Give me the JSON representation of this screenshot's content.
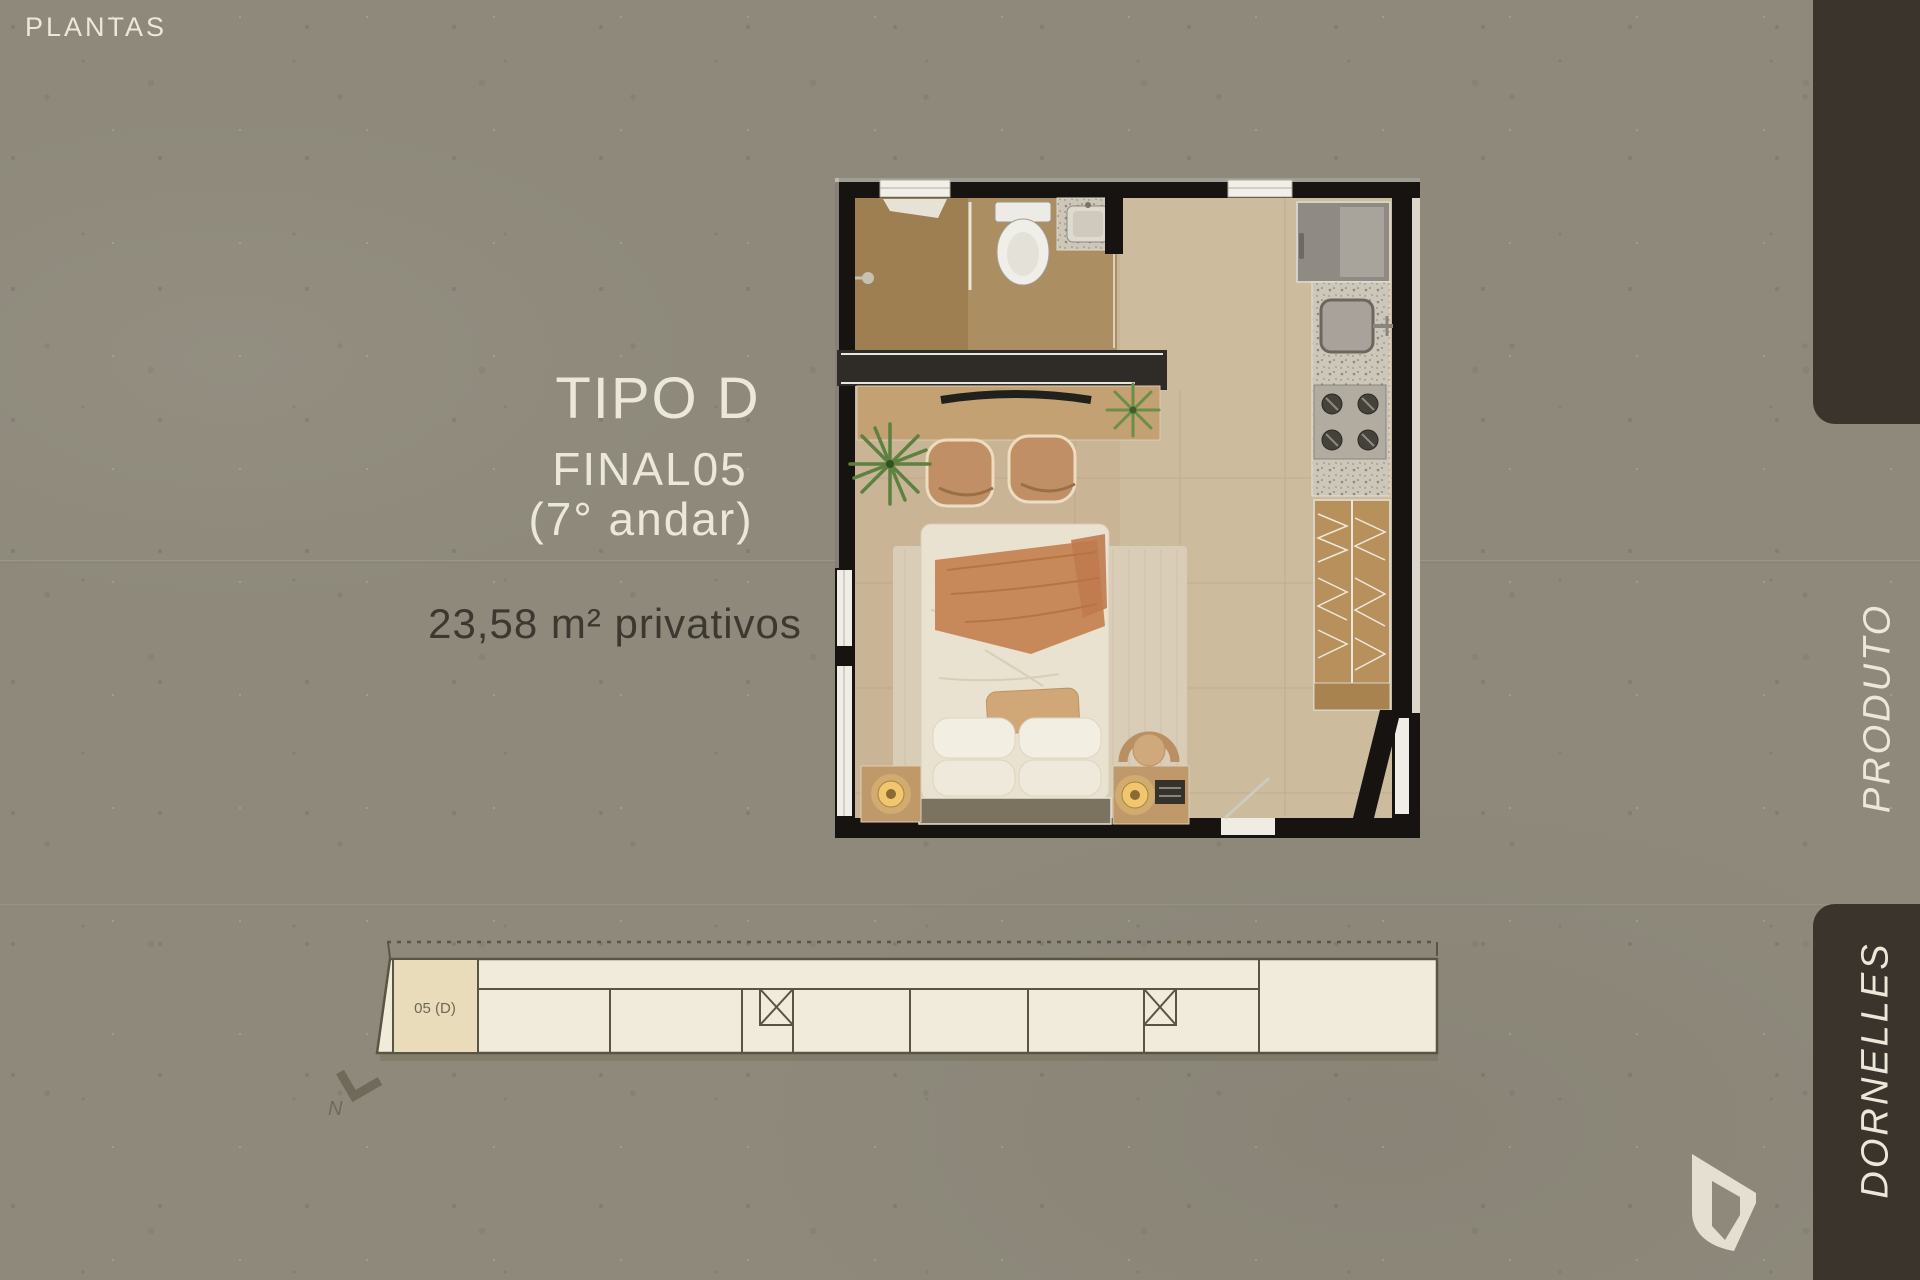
{
  "slide": {
    "section_label": "PLANTAS"
  },
  "unit_info": {
    "type": "TIPO D",
    "final": "FINAL05",
    "floor": "(7° andar)",
    "area": "23,58 m² privativos"
  },
  "keyplan": {
    "highlight_label": "05 (D)",
    "north_label": "N"
  },
  "nav": {
    "produto": "PRODUTO",
    "dornelles": "DORNELLES"
  },
  "colors": {
    "background": "#8e897b",
    "sidebar_rail": "#3a342c",
    "cream_text": "#ece8d9",
    "dark_text": "#3c3830",
    "keyplan_fill": "#f0ebdb",
    "keyplan_highlight": "#e8dcba",
    "keyplan_stroke": "#5a5443",
    "plan_wall": "#171310",
    "plan_floor": "#c9b495",
    "logo_cream": "#e4dfd1"
  },
  "floorplan_elements": [
    "bathroom",
    "shower",
    "toilet",
    "vanity-sink",
    "window",
    "tv-console",
    "tv",
    "desk",
    "chairs",
    "plants",
    "rug",
    "bed",
    "pillows",
    "blanket",
    "headboard",
    "nightstand",
    "lamp",
    "pouf",
    "kitchen-fridge",
    "kitchen-counter",
    "kitchen-sink",
    "cooktop",
    "wardrobe",
    "entry-door",
    "glass-door"
  ]
}
